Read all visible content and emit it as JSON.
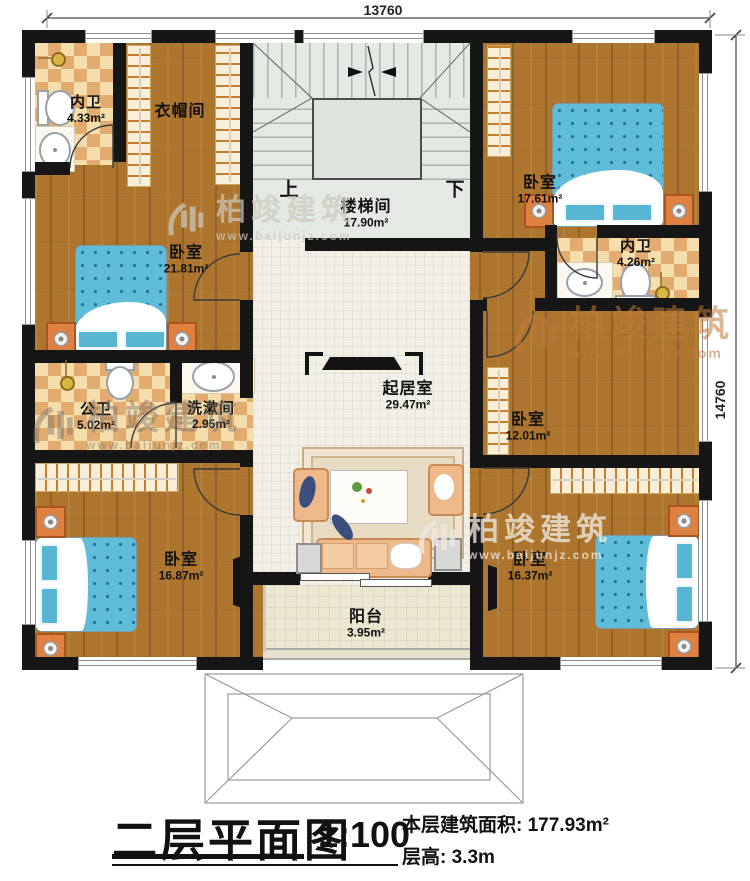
{
  "watermark": {
    "brand": "柏竣建筑",
    "url": "www.baijunjz.com"
  },
  "dimensions": {
    "top": "13760",
    "right": "14760"
  },
  "stairs": {
    "up": "上",
    "down": "下"
  },
  "rooms": {
    "bath_tl": {
      "name": "内卫",
      "area": "4.33m²"
    },
    "cloak": {
      "name": "衣帽间"
    },
    "stair": {
      "name": "楼梯间",
      "area": "17.90m²"
    },
    "bed_tr": {
      "name": "卧室",
      "area": "17.61m²"
    },
    "bath_r": {
      "name": "内卫",
      "area": "4.26m²"
    },
    "bed_l": {
      "name": "卧室",
      "area": "21.81m²"
    },
    "pub_bath": {
      "name": "公卫",
      "area": "5.02m²"
    },
    "wash": {
      "name": "洗漱间",
      "area": "2.95m²"
    },
    "living": {
      "name": "起居室",
      "area": "29.47m²"
    },
    "bed_mr": {
      "name": "卧室",
      "area": "12.01m²"
    },
    "bed_bl": {
      "name": "卧室",
      "area": "16.87m²"
    },
    "bed_br": {
      "name": "卧室",
      "area": "16.37m²"
    },
    "balcony": {
      "name": "阳台",
      "area": "3.95m²"
    }
  },
  "title_block": {
    "title": "二层平面图",
    "scale": "1:100",
    "area_label": "本层建筑面积: 177.93m²",
    "height_label": "层高: 3.3m"
  }
}
